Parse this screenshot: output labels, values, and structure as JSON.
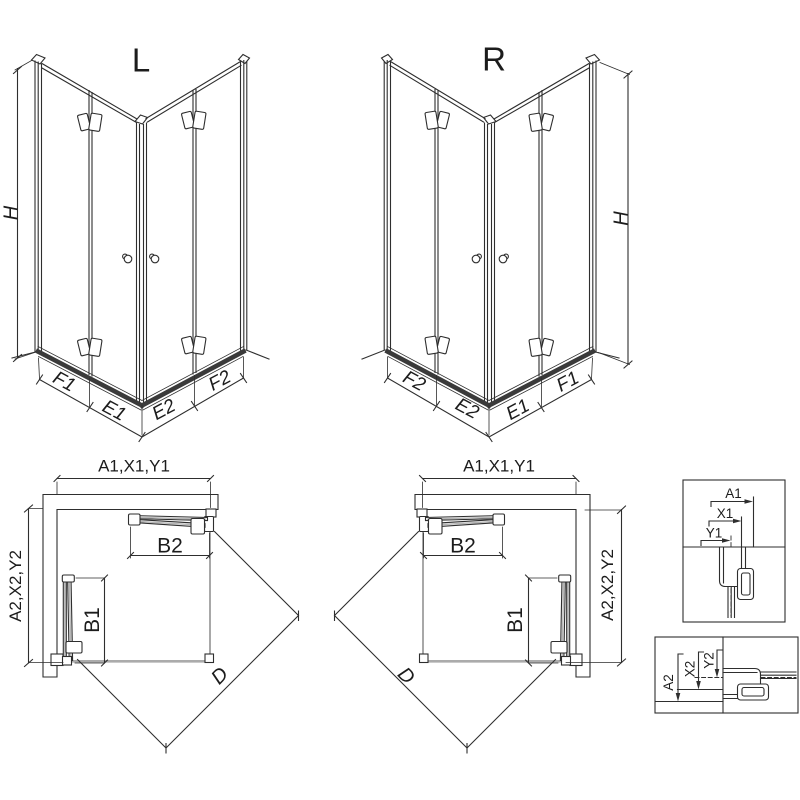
{
  "drawing": {
    "iso_left": {
      "label": "L",
      "height_dim": "H",
      "bottom_dims": [
        "F1",
        "E1",
        "E2",
        "F2"
      ]
    },
    "iso_right": {
      "label": "R",
      "height_dim": "H",
      "bottom_dims": [
        "F2",
        "E2",
        "E1",
        "F1"
      ]
    },
    "plan_left": {
      "width_dim": "A1,X1,Y1",
      "depth_dim": "A2,X2,Y2",
      "open_door_top": "B2",
      "open_door_side": "B1",
      "diagonal_dim": "D"
    },
    "plan_right": {
      "width_dim": "A1,X1,Y1",
      "depth_dim": "A2,X2,Y2",
      "open_door_top": "B2",
      "open_door_side": "B1",
      "diagonal_dim": "D"
    },
    "detail_top": {
      "dims": [
        "A1",
        "X1",
        "Y1"
      ]
    },
    "detail_bottom": {
      "dims": [
        "A2",
        "X2",
        "Y2"
      ]
    },
    "colors": {
      "line": "#2e2e2e",
      "rail": "#3a3a3a",
      "floor": "#ababab",
      "trace": "#6e6e6e",
      "glass": "#b5b5b5",
      "text": "#1c1c1c",
      "background": "#ffffff"
    }
  }
}
